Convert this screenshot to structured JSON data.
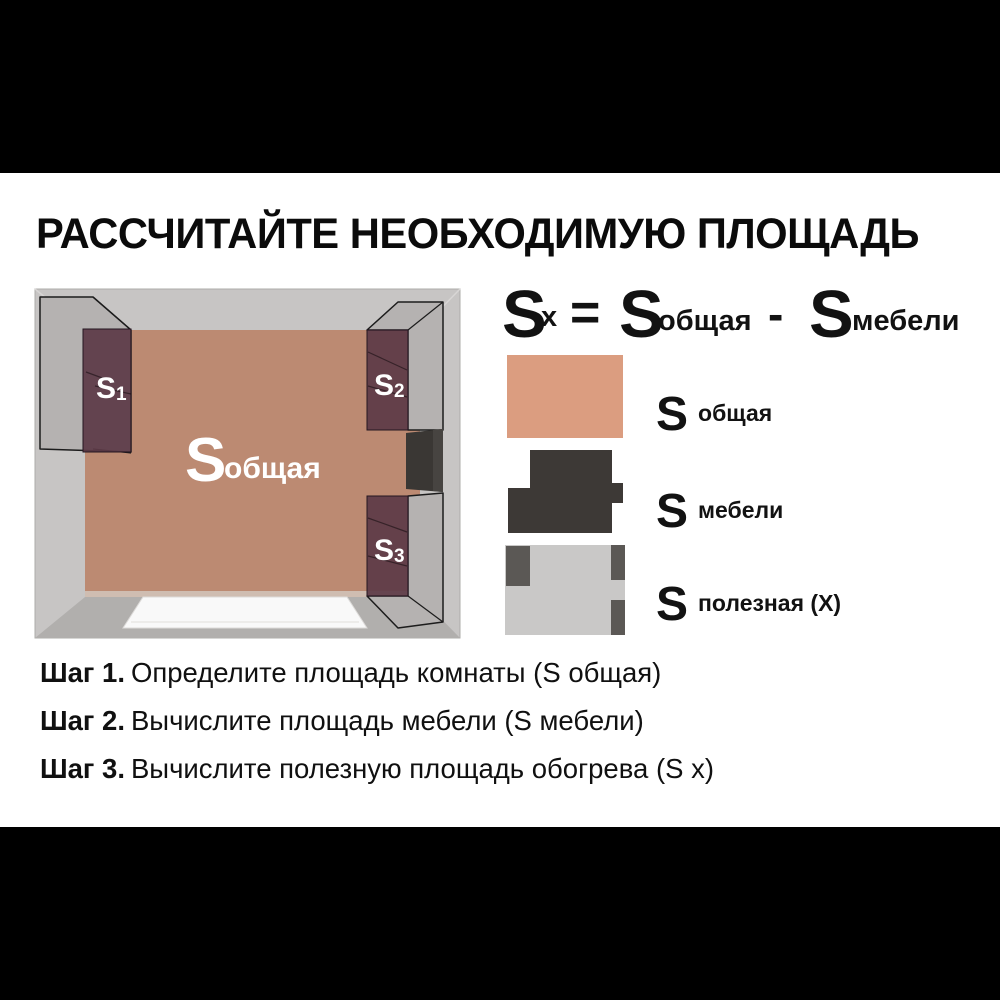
{
  "title": "РАССЧИТАЙТЕ НЕОБХОДИМУЮ ПЛОЩАДЬ",
  "room_diagram": {
    "floor_label": {
      "s": "S",
      "sub": "общая"
    },
    "furniture_labels": [
      {
        "s": "S",
        "sub": "1"
      },
      {
        "s": "S",
        "sub": "2"
      },
      {
        "s": "S",
        "sub": "3"
      }
    ]
  },
  "formula": {
    "lhs_s": "S",
    "lhs_sub": "x",
    "equals": "=",
    "total_s": "S",
    "total_sub": "общая",
    "minus": "-",
    "furn_s": "S",
    "furn_sub": "мебели"
  },
  "legend": {
    "items": [
      {
        "s": "S",
        "label": "общая"
      },
      {
        "s": "S",
        "label": "мебели"
      },
      {
        "s": "S",
        "label": "полезная (X)"
      }
    ]
  },
  "steps": [
    {
      "prefix": "Шаг 1.",
      "text": "Определите площадь комнаты (S общая)"
    },
    {
      "prefix": "Шаг 2.",
      "text": "Вычислите площадь мебели (S мебели)"
    },
    {
      "prefix": "Шаг 3.",
      "text": "Вычислите полезную площадь обогрева (S x)"
    }
  ],
  "colors": {
    "floor": "#bc8a72",
    "total_area_swatch": "#db9d80",
    "furniture_maroon": "#5c3946",
    "furniture_dark": "#3d3936",
    "useful_light": "#c9c8c7",
    "useful_dark": "#5b5855",
    "wall_gray": "#c7c5c4",
    "door_dark": "#3a3734",
    "text": "#0e0e0e"
  }
}
